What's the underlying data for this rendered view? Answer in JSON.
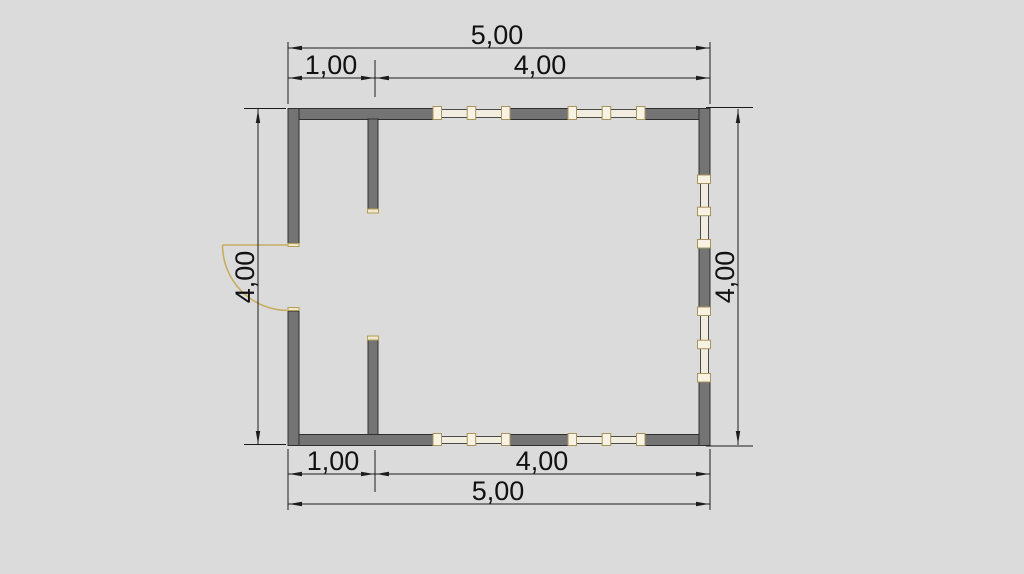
{
  "plan": {
    "kind": "floor-plan",
    "dimensions": {
      "top_overall": "5,00",
      "top_segment_small": "1,00",
      "top_segment_large": "4,00",
      "bottom_overall": "5,00",
      "bottom_segment_small": "1,00",
      "bottom_segment_large": "4,00",
      "left_side": "4,00",
      "right_side": "4,00"
    },
    "features": {
      "exterior_wall_sides": 4,
      "interior_partitions": 2,
      "windows_top_wall": 2,
      "windows_bottom_wall": 2,
      "windows_right_wall": 2,
      "door": "outswing door on left wall with quarter-circle swing arc"
    },
    "colors": {
      "background": "#dbdbdb",
      "wall_fill": "#747474",
      "wall_outline": "#2f2f2f",
      "window_fill": "#f2ede1",
      "window_frame": "#4c4a44",
      "window_post_outline": "#a8945c",
      "jamb_cap": "#efe8cf",
      "door_swing": "#c7ad62",
      "dimension_line": "#1c1c1c",
      "dimension_text": "#111111"
    }
  }
}
